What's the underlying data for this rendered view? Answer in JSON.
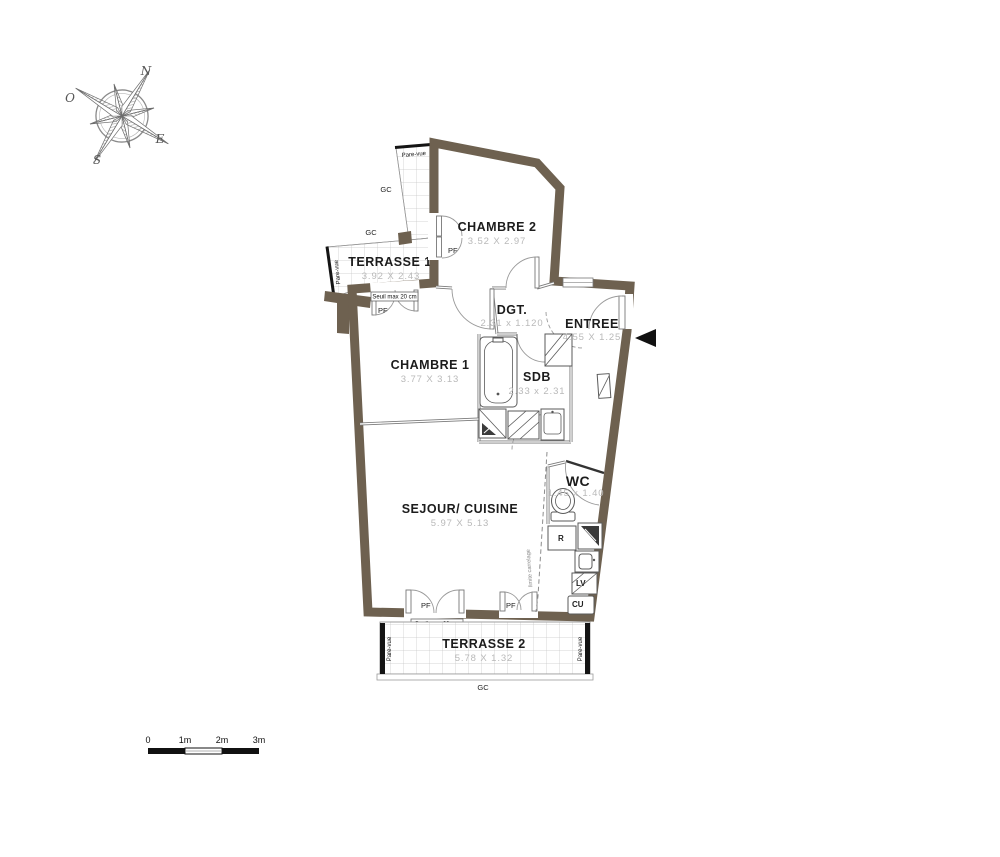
{
  "compass": {
    "north": "N",
    "ouest": "O",
    "est": "E",
    "sud": "S"
  },
  "rooms": {
    "chambre2": {
      "name": "CHAMBRE 2",
      "dims": "3.52 X 2.97"
    },
    "terrasse1": {
      "name": "TERRASSE 1",
      "dims": "3.92 X 2.43"
    },
    "chambre1": {
      "name": "CHAMBRE 1",
      "dims": "3.77 X 3.13"
    },
    "degagement": {
      "name": "DGT.",
      "dims": "2.31 x 1.120"
    },
    "entree": {
      "name": "ENTREE",
      "dims": "4.55 X 1.25"
    },
    "sdb": {
      "name": "SDB",
      "dims": "2.33 x 2.31"
    },
    "wc": {
      "name": "WC",
      "dims": "1.45 x 1.40"
    },
    "sejour_cuisine": {
      "name": "SEJOUR/ CUISINE",
      "dims": "5.97 X 5.13"
    },
    "terrasse2": {
      "name": "TERRASSE 2",
      "dims": "5.78 X 1.32"
    }
  },
  "annotations": {
    "pare_vue": "Pare-vue",
    "gc": "GC",
    "pf": "PF",
    "seuil": "Seuil max 20 cm",
    "refrigerateur": "R",
    "lave_vaisselle": "LV",
    "cuisson": "CU",
    "limite_carrelage": "limite carrelage"
  },
  "scale_bar": {
    "ticks": [
      "0",
      "1m",
      "2m",
      "3m"
    ]
  },
  "colors": {
    "wall": "#6e6150",
    "dim_text": "#b9b9b9",
    "grid_line": "#c6c6c6"
  }
}
